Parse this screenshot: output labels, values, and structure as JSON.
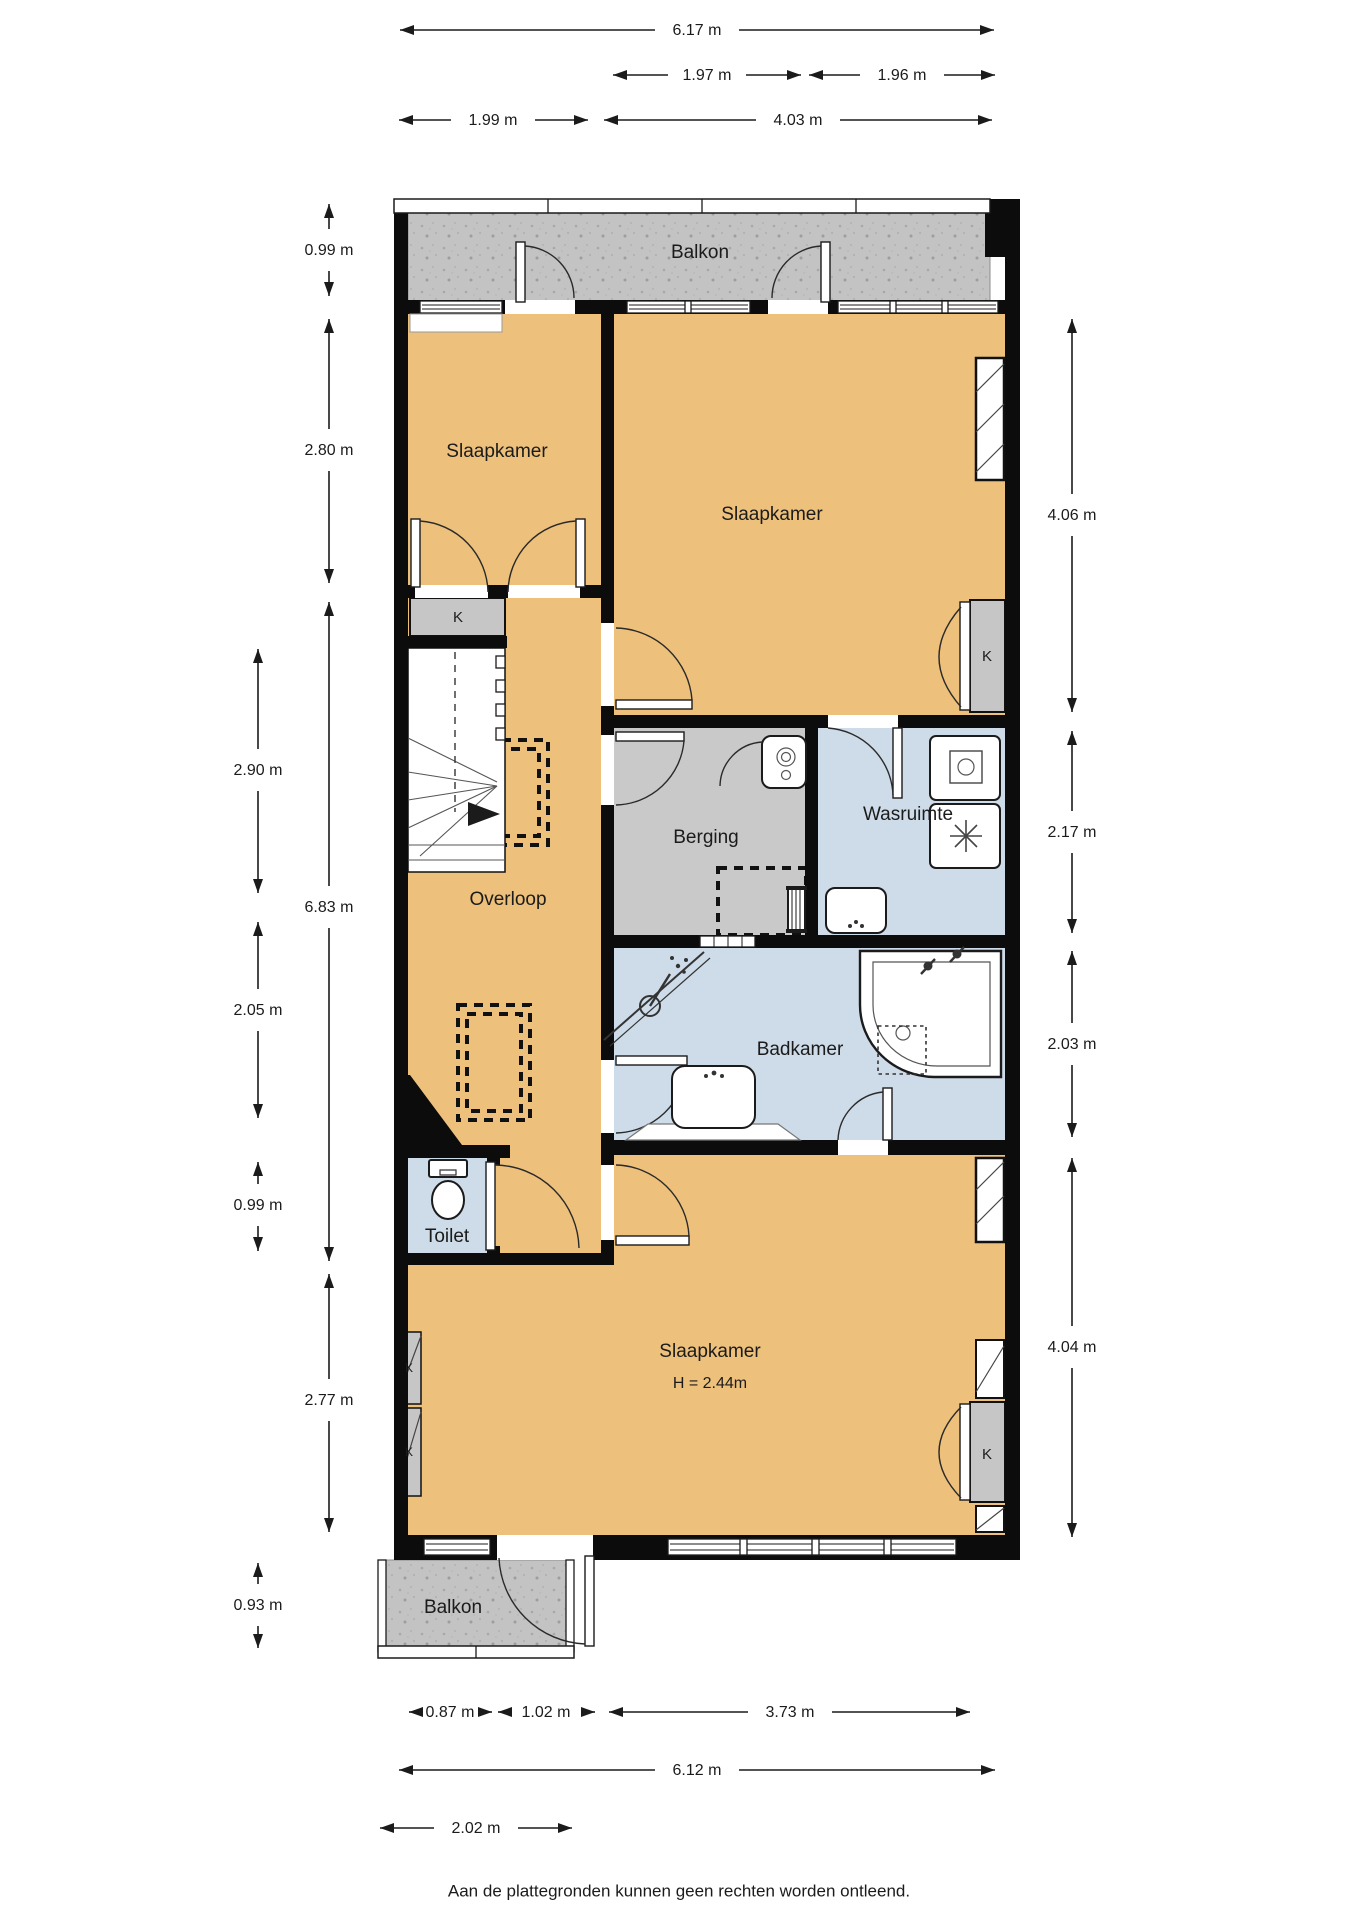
{
  "rooms": {
    "balkon_top": "Balkon",
    "slaapkamer_left": "Slaapkamer",
    "slaapkamer_right": "Slaapkamer",
    "overloop": "Overloop",
    "berging": "Berging",
    "wasruimte": "Wasruimte",
    "badkamer": "Badkamer",
    "toilet": "Toilet",
    "slaapkamer_bottom": "Slaapkamer",
    "slaapkamer_bottom_height": "H = 2.44m",
    "balkon_bottom": "Balkon",
    "closet": "K"
  },
  "dimensions": {
    "top": {
      "total": "6.17 m",
      "window_left": "1.97 m",
      "window_right": "1.96 m",
      "left_room": "1.99 m",
      "right_room": "4.03 m"
    },
    "left": {
      "balkon": "0.99 m",
      "slaapkamer": "2.80 m",
      "trap": "2.90 m",
      "hal_totaal": "6.83 m",
      "overloop": "2.05 m",
      "toilet": "0.99 m",
      "slaapkamer_onder": "2.77 m",
      "balkon_onder": "0.93 m"
    },
    "right": {
      "slaapkamer": "4.06 m",
      "berging_wasruimte": "2.17 m",
      "badkamer": "2.03 m",
      "slaapkamer_onder": "4.04 m"
    },
    "bottom": {
      "segment_a": "0.87 m",
      "segment_b": "1.02 m",
      "segment_c": "3.73 m",
      "total": "6.12 m",
      "balkon": "2.02 m"
    }
  },
  "footer": {
    "disclaimer": "Aan de plattegronden kunnen geen rechten worden ontleend."
  },
  "colors": {
    "room_orange": "#edc07c",
    "service_gray": "#c9c9c9",
    "wet_blue": "#cedbe8",
    "balcony_gray": "#c3c3c3",
    "wall_black": "#0c0c0c"
  }
}
